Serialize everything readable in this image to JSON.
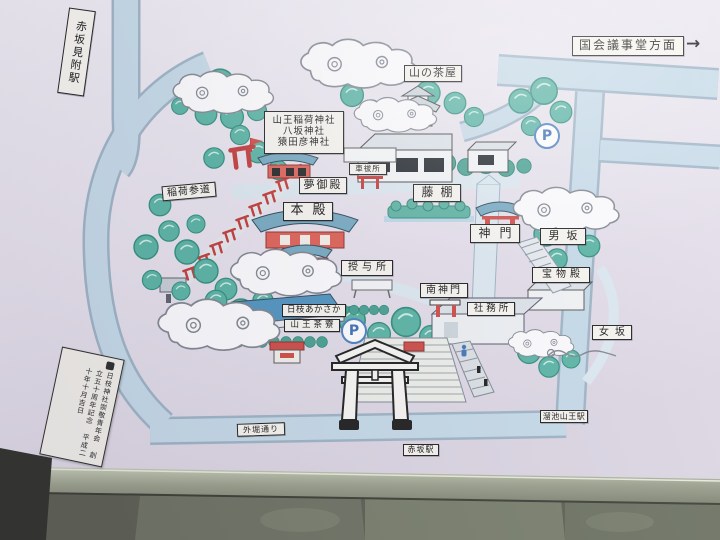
{
  "stations": {
    "akasaka_mitsuke": "赤坂見附駅",
    "tameike_sanno": "溜池山王駅",
    "akasaka": "赤坂駅"
  },
  "directions": {
    "kokkai_gijido": "国会議事堂方面",
    "arrow": "→"
  },
  "places": {
    "yama_no_chaya": "山の茶屋",
    "sanno_inari_jinja": "山王稲荷神社",
    "yasaka_jinja": "八坂神社",
    "sarutahiko_jinja": "猿田彦神社",
    "yume_goten": "夢御殿",
    "inari_sando": "稲荷参道",
    "kuruma_haraisho": "車祓所",
    "fujidana": "藤棚",
    "honden": "本殿",
    "shinmon": "神門",
    "otokozaka": "男坂",
    "homotsuden": "宝物殿",
    "juyosho": "授与所",
    "minami_shinmon": "南神門",
    "shamusho": "社務所",
    "hie_akasaka": "日枝あかさか",
    "sanno_saryo": "山王茶寮",
    "onnazaka": "女坂",
    "sotobori_dori": "外堀通り"
  },
  "parking_symbol": "P",
  "memorial_plaque": {
    "col1": "日枝神社崇敬青年会",
    "col2": "創立五十周年記念",
    "col3": "平成二十年十月吉日"
  },
  "colors": {
    "sign_bg": "#e7e3ed",
    "road": "#c6dbe9",
    "road_edge": "#9db4c6",
    "inner_path": "#dde9f1",
    "tree": "#58b4a4",
    "tree_dark": "#45a191",
    "cloud_outline": "#80868f",
    "shrine_red": "#cf4a44",
    "roof_blue": "#76aac2",
    "parking_blue": "#3f74b8",
    "label_bg": "#f8f6f0",
    "frame_metal": "#9aa08c",
    "stone_base": "#5b5e52"
  }
}
